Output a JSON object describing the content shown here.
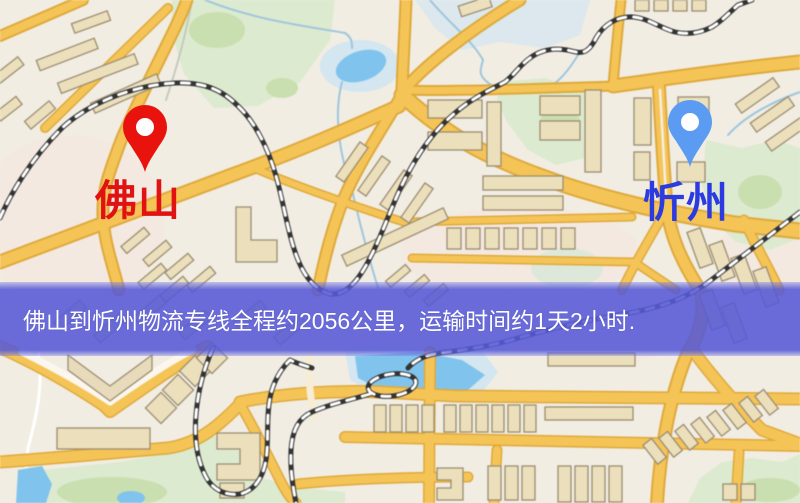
{
  "map": {
    "markers": [
      {
        "id": "foshan",
        "label": "佛山",
        "pin_color": "#e8130c",
        "label_color": "#e01212"
      },
      {
        "id": "xinzhou",
        "label": "忻州",
        "pin_color": "#5b9bf2",
        "label_color": "#2b3be0"
      }
    ],
    "banner": {
      "text": "佛山到忻州物流专线全程约2056公里，运输时间约1天2小时.",
      "background": "#5659d6",
      "text_color": "#ffffff"
    },
    "palette": {
      "map_background": "#f1ede3",
      "road_major": "#f4c45a",
      "road_casing": "#dda93f",
      "building_fill": "#ebdfbd",
      "park_green": "#dcead0",
      "water_blue": "#82c4eb",
      "railway_dark": "#333333"
    }
  }
}
